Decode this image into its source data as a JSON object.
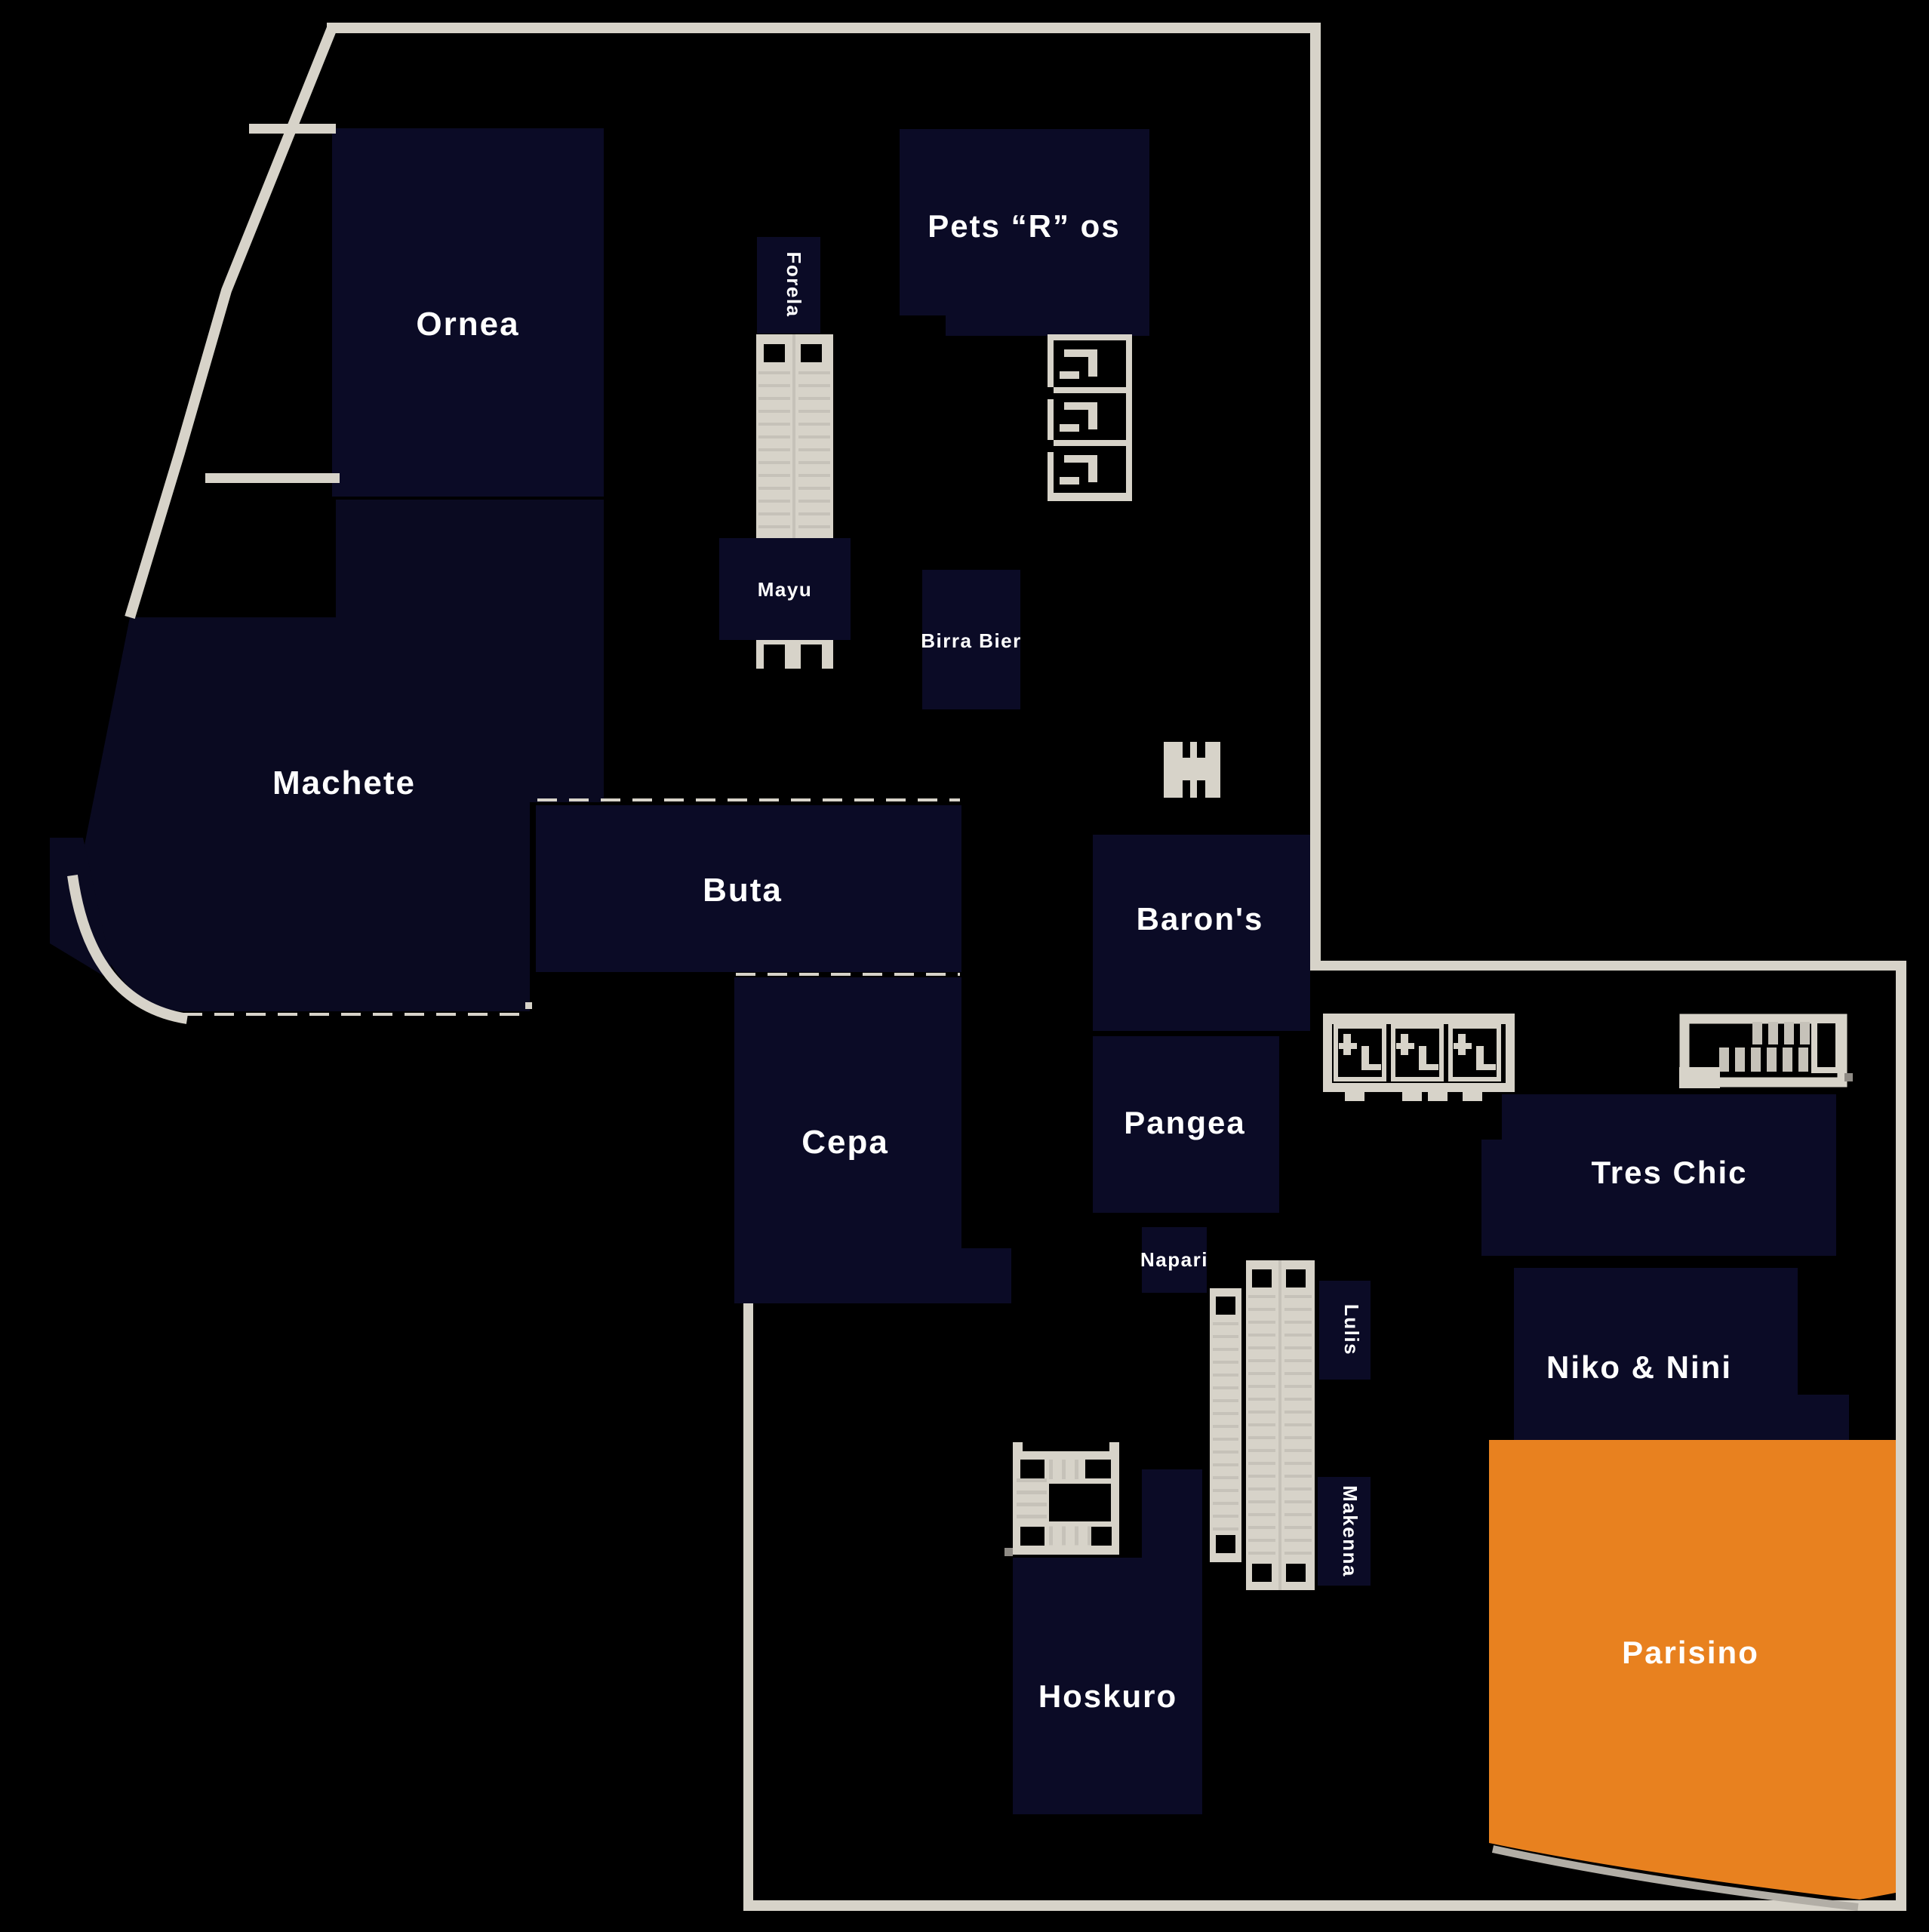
{
  "map": {
    "kind": "mall-floor-plan",
    "colors": {
      "background": "#000000",
      "store_fill": "#0b0b26",
      "highlight_fill": "#e8811f",
      "wall": "#d7d3c9",
      "wall_shadow": "#b2aea6",
      "label": "#ffffff"
    },
    "highlighted_store": "Parisino",
    "stores": [
      {
        "id": "ornea",
        "label": "Ornea"
      },
      {
        "id": "machete",
        "label": "Machete"
      },
      {
        "id": "buta",
        "label": "Buta"
      },
      {
        "id": "cepa",
        "label": "Cepa"
      },
      {
        "id": "pets-r-os",
        "label": "Pets “R” os"
      },
      {
        "id": "forela",
        "label": "Forela"
      },
      {
        "id": "mayu",
        "label": "Mayu"
      },
      {
        "id": "birra-bier",
        "label": "Birra Bier"
      },
      {
        "id": "barons",
        "label": "Baron's"
      },
      {
        "id": "pangea",
        "label": "Pangea"
      },
      {
        "id": "napari",
        "label": "Napari"
      },
      {
        "id": "lulis",
        "label": "Lulis"
      },
      {
        "id": "makenna",
        "label": "Makenna"
      },
      {
        "id": "tres-chic",
        "label": "Tres Chic"
      },
      {
        "id": "niko-nini",
        "label": "Niko & Nini"
      },
      {
        "id": "parisino",
        "label": "Parisino",
        "highlighted": true
      },
      {
        "id": "hoskuro",
        "label": "Hoskuro"
      }
    ],
    "icons": [
      "escalator-icon",
      "escalator-long-icon",
      "escalator-bank-icon",
      "stairs-icon",
      "stairs-upper-right-icon",
      "stairwell-icon",
      "elevator-icon"
    ]
  }
}
